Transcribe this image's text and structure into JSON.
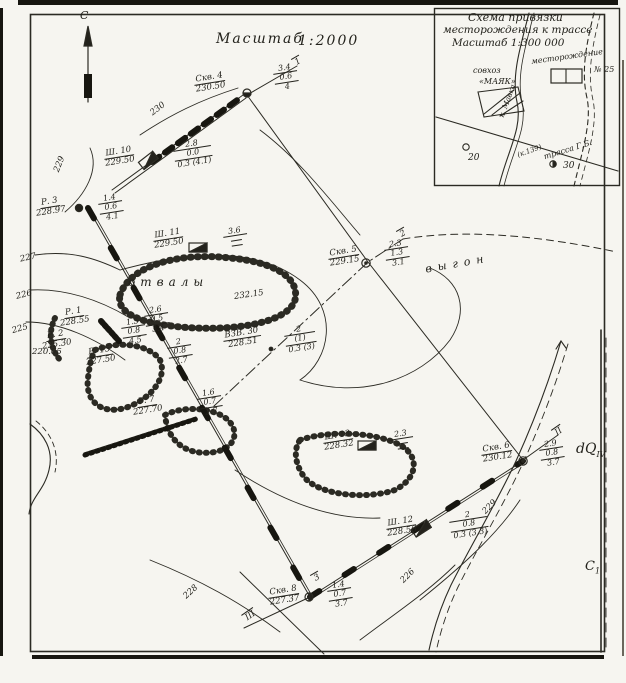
{
  "map_title": {
    "scale_word": "Масштаб",
    "scale_value": "1:2000",
    "north": "С"
  },
  "inset": {
    "title1": "Схема привязки",
    "title2": "месторождения к трассе",
    "title3": "Масштаб 1:300 000",
    "sovkhoz": "совхоз",
    "mayak": "«МАЯК»",
    "deposit": "месторождение",
    "deposit_no": "№ 25",
    "road": "трасса Г.Б.",
    "river": "к. Мавка",
    "pk": "(к.139)",
    "km20": "20",
    "km30": "30"
  },
  "terrain": {
    "otvaly": "отвалы",
    "vygon": "выгон"
  },
  "geology": {
    "dq": "dQ",
    "dq_sub": "IV",
    "c1": "С",
    "c1_sub": "1"
  },
  "contour_labels": [
    {
      "t": "230"
    },
    {
      "t": "229"
    },
    {
      "t": "227"
    },
    {
      "t": "226"
    },
    {
      "t": "225"
    },
    {
      "t": "228"
    },
    {
      "t": "229"
    },
    {
      "t": "226"
    }
  ],
  "spot_heights": [
    {
      "t": "232.15"
    },
    {
      "t": "220.05"
    }
  ],
  "profile_markers": [
    {
      "t": "1"
    },
    {
      "t": "2"
    },
    {
      "t": "3"
    },
    {
      "t": "II"
    },
    {
      "t": "III"
    }
  ],
  "points": [
    {
      "name": "Скв. 4",
      "elev": "230.50",
      "f1": "3.4",
      "f2": "0.6",
      "f3": "4"
    },
    {
      "name": "Ш. 10",
      "elev": "229.50",
      "f1": "2.8",
      "f2": "0.0",
      "f3": "0.3 (4.1)"
    },
    {
      "name": "Р. 3",
      "elev": "228.97",
      "f1": "1.4",
      "f2": "0.6",
      "f3": "4.1"
    },
    {
      "name": "Ш. 11",
      "elev": "229.50",
      "f1": "3.6"
    },
    {
      "name": "Скв. 5",
      "elev": "229.15",
      "f1": "2.3",
      "f2": "1.3",
      "f3": "3.1"
    },
    {
      "name": "Р. 1",
      "elev": "228.55",
      "f1": "2.6",
      "f2": "0.5",
      "f3": "3.4"
    },
    {
      "name": "Р. 2",
      "elev": "225.30",
      "f1": "1.5",
      "f2": "0.8",
      "f3": "4.5"
    },
    {
      "name": "Р. 15",
      "elev": "227.50",
      "f1": "2",
      "f2": "0.8",
      "f3": "2.7"
    },
    {
      "name": "ВЗВ. 30",
      "elev": "228.51",
      "f1": "2",
      "f2": "(1)",
      "f3": "0.3 (3)"
    },
    {
      "name": "Р. 7",
      "elev": "227.70",
      "f1": "1.6",
      "f2": "0.7",
      "f3": "2.7"
    },
    {
      "name": "Ш. 13",
      "elev": "228.32",
      "f1": "2.3"
    },
    {
      "name": "Скв. 6",
      "elev": "230.12",
      "f1": "2.9",
      "f2": "0.8",
      "f3": "3.7"
    },
    {
      "name": "Ш. 12",
      "elev": "228.56",
      "f1": "2",
      "f2": "0.8",
      "f3": "0.3 (3.3)"
    },
    {
      "name": "Скв. 8",
      "elev": "227.37",
      "f1": "1.4",
      "f2": "0.7",
      "f3": "3.7"
    }
  ]
}
